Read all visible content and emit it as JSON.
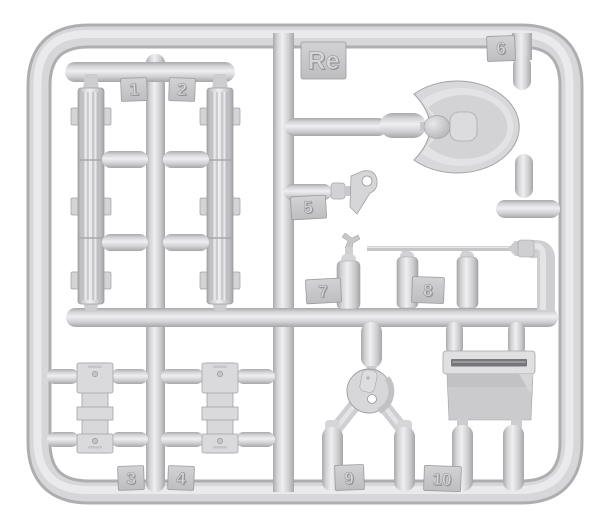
{
  "scene": {
    "description": "Injection-molded light grey plastic model kit sprue (runner frame) with numbered parts on white background",
    "background_color": "#ffffff",
    "plastic_color": "#d6d6d8",
    "highlight_color": "#efeff1",
    "shadow_color": "#a9a9ac",
    "slot_dark_color": "#77777b"
  },
  "sprue": {
    "gate_label": "Re",
    "tabs": [
      {
        "id": "re",
        "label": "Re"
      },
      {
        "id": "1",
        "label": "1"
      },
      {
        "id": "2",
        "label": "2"
      },
      {
        "id": "3",
        "label": "3"
      },
      {
        "id": "4",
        "label": "4"
      },
      {
        "id": "5",
        "label": "5"
      },
      {
        "id": "6",
        "label": "6"
      },
      {
        "id": "7",
        "label": "7"
      },
      {
        "id": "8",
        "label": "8"
      },
      {
        "id": "9",
        "label": "9"
      },
      {
        "id": "10",
        "label": "10"
      }
    ],
    "parts": [
      {
        "number": "1",
        "shape": "ribbed-slat-panel-left"
      },
      {
        "number": "2",
        "shape": "ribbed-slat-panel-right"
      },
      {
        "number": "3",
        "shape": "notched-hatch-plate-left"
      },
      {
        "number": "4",
        "shape": "notched-hatch-plate-right"
      },
      {
        "number": "5",
        "shape": "small-bracket-with-hole"
      },
      {
        "number": "6",
        "shape": "oval-scoop-shell"
      },
      {
        "number": "7",
        "shape": "small-canister-with-handle"
      },
      {
        "number": "8",
        "shape": "two-cylinders-with-pointed-rod"
      },
      {
        "number": "9",
        "shape": "fork-mount-with-pierced-disc"
      },
      {
        "number": "10",
        "shape": "stowage-box-with-slot"
      }
    ]
  }
}
